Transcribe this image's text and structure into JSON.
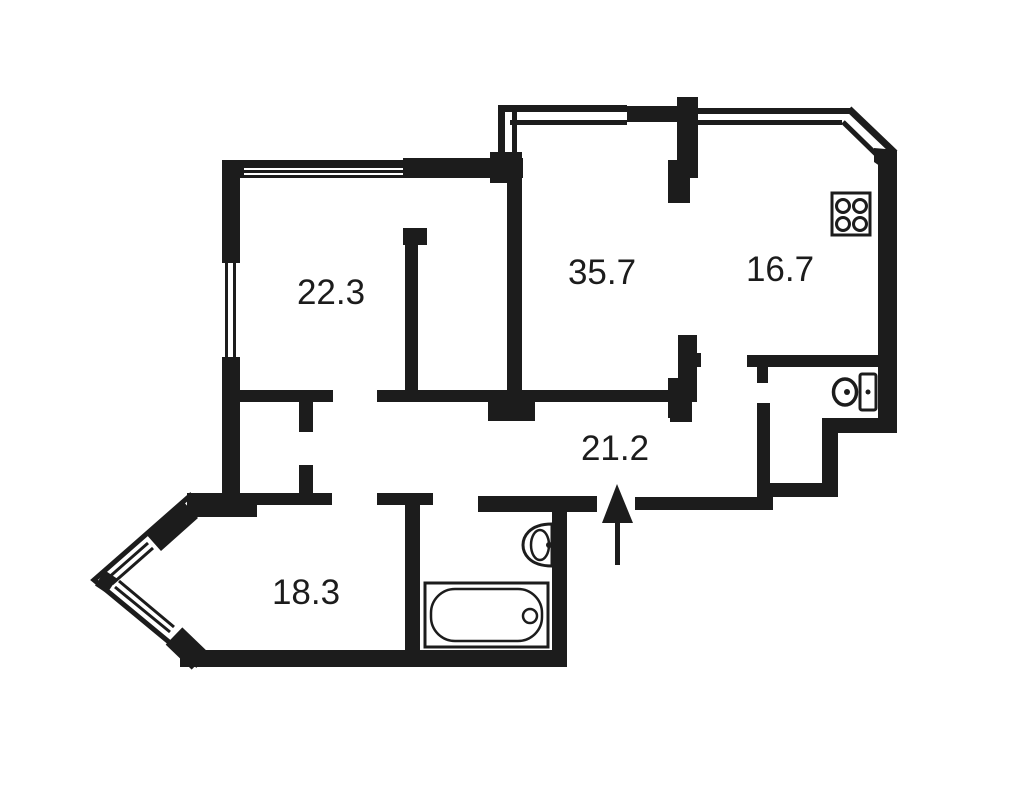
{
  "title": "apartment-floor-plan",
  "colors": {
    "wall": "#1c1c1c",
    "background": "#ffffff"
  },
  "rooms": [
    {
      "name": "room-top-left",
      "area": "22.3"
    },
    {
      "name": "room-living",
      "area": "35.7"
    },
    {
      "name": "room-kitchen",
      "area": "16.7"
    },
    {
      "name": "hallway",
      "area": "21.2"
    },
    {
      "name": "room-bottom-left",
      "area": "18.3"
    }
  ],
  "fixtures": [
    {
      "name": "stove-icon"
    },
    {
      "name": "toilet-icon"
    },
    {
      "name": "sink-icon"
    },
    {
      "name": "bathtub-icon"
    },
    {
      "name": "entrance-arrow-icon"
    }
  ]
}
